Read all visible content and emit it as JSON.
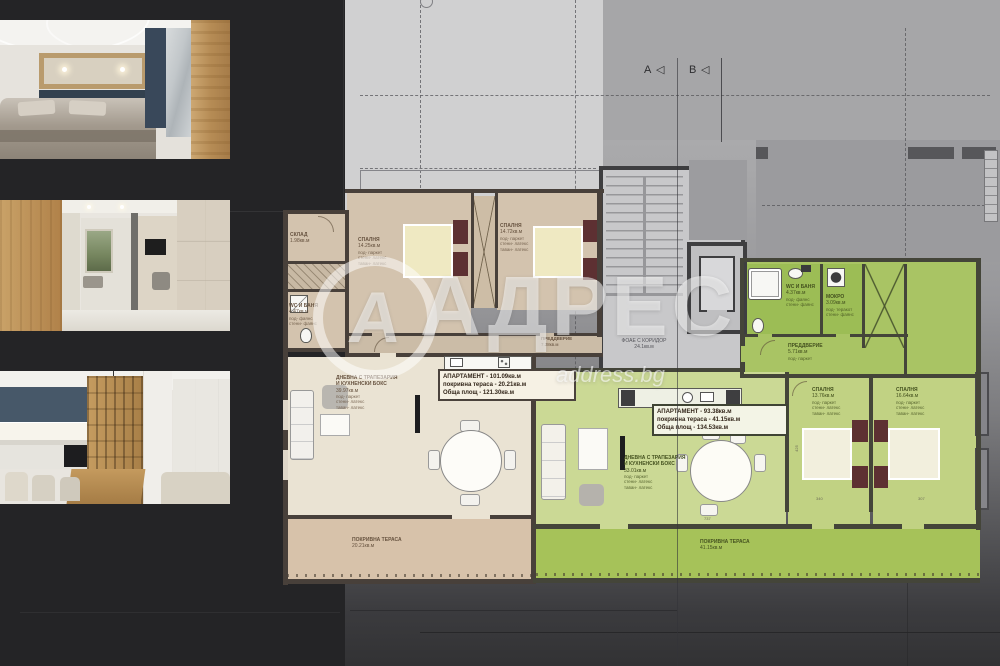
{
  "brand": {
    "logo_letter": "А",
    "name": "АДРЕС",
    "site": "address.bg"
  },
  "markers": {
    "a": "A",
    "b": "B",
    "triangle": "◁"
  },
  "stair": {
    "label": "ФОАЕ С КОРИДОР",
    "area": "24.1кв.м"
  },
  "apt_left": {
    "info1": "АПАРТАМЕНТ - 101.09кв.м",
    "info2": "покривна тераса - 20.21кв.м",
    "info3": "Обща площ - 121.30кв.м",
    "storage": {
      "name": "СКЛАД",
      "area": "1.98кв.м"
    },
    "bath": {
      "name": "WC И БАНЯ",
      "area": "4.47кв.м",
      "spec": "под- фаянс\nстени- фаянс"
    },
    "bedroom1": {
      "name": "СПАЛНЯ",
      "area": "14.25кв.м",
      "spec": "под- паркет\nстени- латекс\nтаван- латекс"
    },
    "bedroom2": {
      "name": "СПАЛНЯ",
      "area": "14.72кв.м",
      "spec": "под- паркет\nстени- латекс\nтаван- латекс"
    },
    "hall": {
      "name": "ПРЕДДВЕРИЕ",
      "area": "7.28кв.м",
      "spec": "под- паркет"
    },
    "living": {
      "name": "ДНЕВНА С ТРАПЕЗАРИЯ\nИ КУХНЕНСКИ БОКС",
      "area": "39.97кв.м",
      "spec": "под- паркет\nстени- латекс\nтаван- латекс"
    },
    "terrace": {
      "name": "ПОКРИВНА ТЕРАСА",
      "area": "20.21кв.м"
    }
  },
  "apt_right": {
    "info1": "АПАРТАМЕНТ - 93.38кв.м",
    "info2": "покривна тераса - 41.15кв.м",
    "info3": "Обща площ - 134.53кв.м",
    "bath": {
      "name": "WC И БАНЯ",
      "area": "4.37кв.м",
      "spec": "под- фаянс\nстени- фаянс"
    },
    "laundry": {
      "name": "МОКРО",
      "area": "3.09кв.м",
      "spec": "под- теракот\nстени- фаянс"
    },
    "hall": {
      "name": "ПРЕДДВЕРИЕ",
      "area": "5.71кв.м",
      "spec": "под- паркет"
    },
    "bedroom1": {
      "name": "СПАЛНЯ",
      "area": "13.76кв.м",
      "spec": "под- паркет\nстени- латекс\nтаван- латекс"
    },
    "bedroom2": {
      "name": "СПАЛНЯ",
      "area": "16.64кв.м",
      "spec": "под- паркет\nстени- латекс\nтаван- латекс"
    },
    "living": {
      "name": "ДНЕВНА С ТРАПЕЗАРИЯ\nИ КУХНЕНСКИ БОКС",
      "area": "33.01кв.м",
      "spec": "под- паркет\nстени- латекс\nтаван- латекс"
    },
    "terrace": {
      "name": "ПОКРИВНА ТЕРАСА",
      "area": "41.15кв.м"
    }
  },
  "dims": {
    "d1": "425",
    "d2": "340",
    "d3": "307",
    "d4": "737"
  },
  "colors": {
    "beige_room": "#d3c3ae",
    "beige_living": "#eae3d3",
    "terrace_beige": "#d7c2aa",
    "green_room": "#9cbd55",
    "green_bedroom": "#c1d283",
    "green_living": "#cbd995",
    "terrace_green": "#a6c259",
    "wall": "#48403a",
    "headboard": "#5d3032"
  }
}
